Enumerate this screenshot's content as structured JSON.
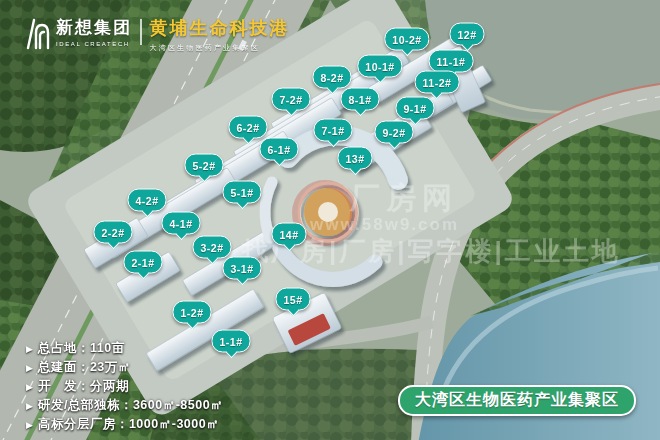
{
  "header": {
    "brand_name": "\u65b0\u60f3\u96c6\u56e2",
    "brand_name_en": "IDEAL CREATECH",
    "title": "\u9ec4\u57d4\u751f\u547d\u79d1\u6280\u6e2f",
    "subtitle": "\u5927\u6e7e\u533a\u751f\u7269\u533b\u836f\u4ea7\u4e1a\u96c6\u805a\u533a"
  },
  "labels": [
    {
      "text": "10-2#",
      "x": 407,
      "y": 39
    },
    {
      "text": "12#",
      "x": 467,
      "y": 34
    },
    {
      "text": "10-1#",
      "x": 380,
      "y": 66
    },
    {
      "text": "11-1#",
      "x": 451,
      "y": 61
    },
    {
      "text": "8-2#",
      "x": 332,
      "y": 77
    },
    {
      "text": "11-2#",
      "x": 437,
      "y": 82
    },
    {
      "text": "7-2#",
      "x": 291,
      "y": 99
    },
    {
      "text": "8-1#",
      "x": 360,
      "y": 99
    },
    {
      "text": "9-1#",
      "x": 415,
      "y": 108
    },
    {
      "text": "6-2#",
      "x": 248,
      "y": 127
    },
    {
      "text": "7-1#",
      "x": 333,
      "y": 130
    },
    {
      "text": "9-2#",
      "x": 394,
      "y": 132
    },
    {
      "text": "6-1#",
      "x": 279,
      "y": 149
    },
    {
      "text": "13#",
      "x": 355,
      "y": 158
    },
    {
      "text": "5-2#",
      "x": 204,
      "y": 165
    },
    {
      "text": "5-1#",
      "x": 242,
      "y": 192
    },
    {
      "text": "4-2#",
      "x": 147,
      "y": 200
    },
    {
      "text": "4-1#",
      "x": 181,
      "y": 223
    },
    {
      "text": "2-2#",
      "x": 113,
      "y": 232
    },
    {
      "text": "14#",
      "x": 289,
      "y": 234
    },
    {
      "text": "3-2#",
      "x": 212,
      "y": 247
    },
    {
      "text": "2-1#",
      "x": 143,
      "y": 262
    },
    {
      "text": "3-1#",
      "x": 242,
      "y": 268
    },
    {
      "text": "15#",
      "x": 293,
      "y": 299
    },
    {
      "text": "1-2#",
      "x": 192,
      "y": 312
    },
    {
      "text": "1-1#",
      "x": 231,
      "y": 341
    }
  ],
  "stats": {
    "items": [
      "\u603b\u5360\u5730\uff1a110\u4ea9",
      "\u603b\u5efa\u9762\uff1a23\u4e07\u33a1",
      "\u5f00\u3000\u53d1\uff1a\u5206\u4e24\u671f",
      "\u7814\u53d1/\u603b\u90e8\u72ec\u680b\uff1a3600\u33a1-8500\u33a1",
      "\u9ad8\u6807\u5206\u5c42\u5382\u623f\uff1a1000\u33a1-3000\u33a1"
    ]
  },
  "banner": {
    "text": "\u5927\u6e7e\u533a\u751f\u7269\u533b\u836f\u4ea7\u4e1a\u96c6\u805a\u533a"
  },
  "watermark": {
    "line1": "\u5382\u623f\u7f51",
    "line2": "www.58w9.com",
    "line3": "\u627e\u5382\u623f|\u5382\u623f|\u5199\u5b57\u697c|\u5de5\u4e1a\u571f\u5730"
  },
  "colors": {
    "label_teal": "#0fa79b",
    "banner_green": "#2fa36c",
    "title_yellow": "#f5c832"
  }
}
